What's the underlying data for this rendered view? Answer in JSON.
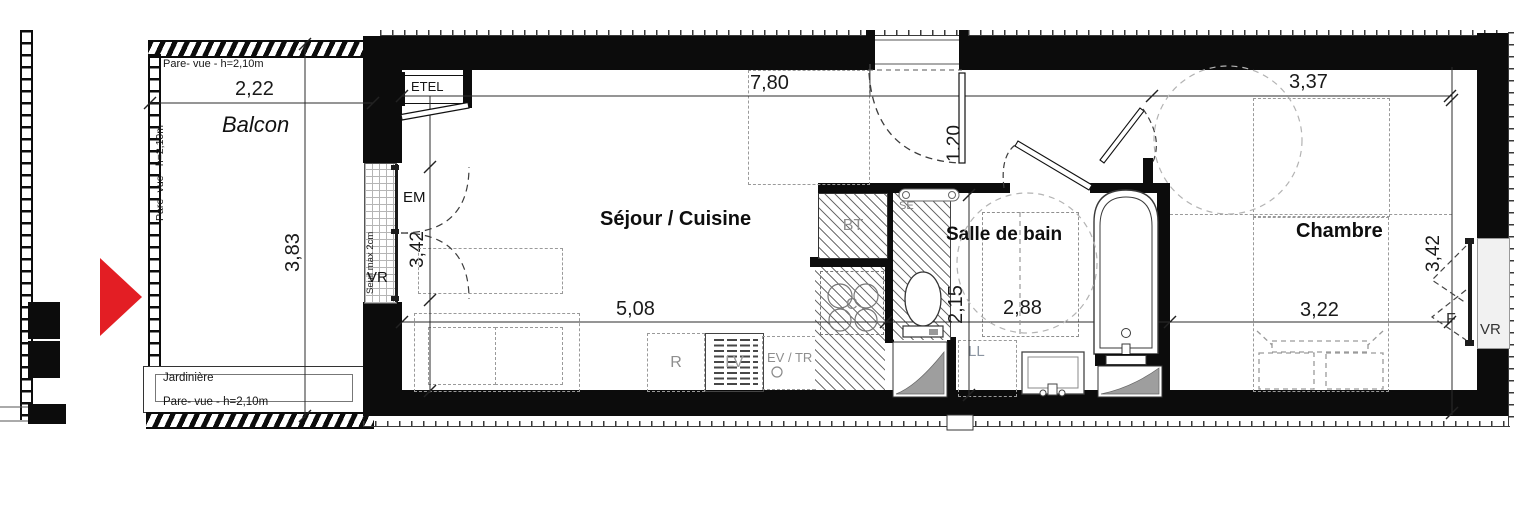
{
  "plan": {
    "entry_arrow_color": "#e31e24",
    "balcony": {
      "label": "Balcon",
      "pare_vue_top": "Pare- vue - h=2,10m",
      "pare_vue_left": "Pare- vue - h=2,10m",
      "pare_vue_bottom": "Pare- vue - h=2,10m",
      "jardiniere": "Jardinière",
      "dim_width": "2,22",
      "dim_depth": "3,83"
    },
    "living_kitchen": {
      "label": "Séjour / Cuisine",
      "dim_top": "7,80",
      "dim_bottom": "5,08",
      "entry_door_dim": "1,20",
      "closet": "ETEL",
      "em": "EM",
      "vr": "VR",
      "sill_note": "Seuil max 2cm",
      "window_dim": "3,42",
      "fridge": "R",
      "dishwasher": "LV",
      "sink": "EV / TR",
      "cooktop": "C",
      "bt": "BT",
      "towel_rail": "SE"
    },
    "bathroom": {
      "label": "Salle de bain",
      "dim_width": "2,88",
      "dim_depth": "2,15",
      "washer": "LL"
    },
    "bedroom": {
      "label": "Chambre",
      "dim_top": "3,37",
      "dim_right": "3,42",
      "dim_bottom": "3,22",
      "window_f": "F",
      "window_vr": "VR"
    }
  }
}
